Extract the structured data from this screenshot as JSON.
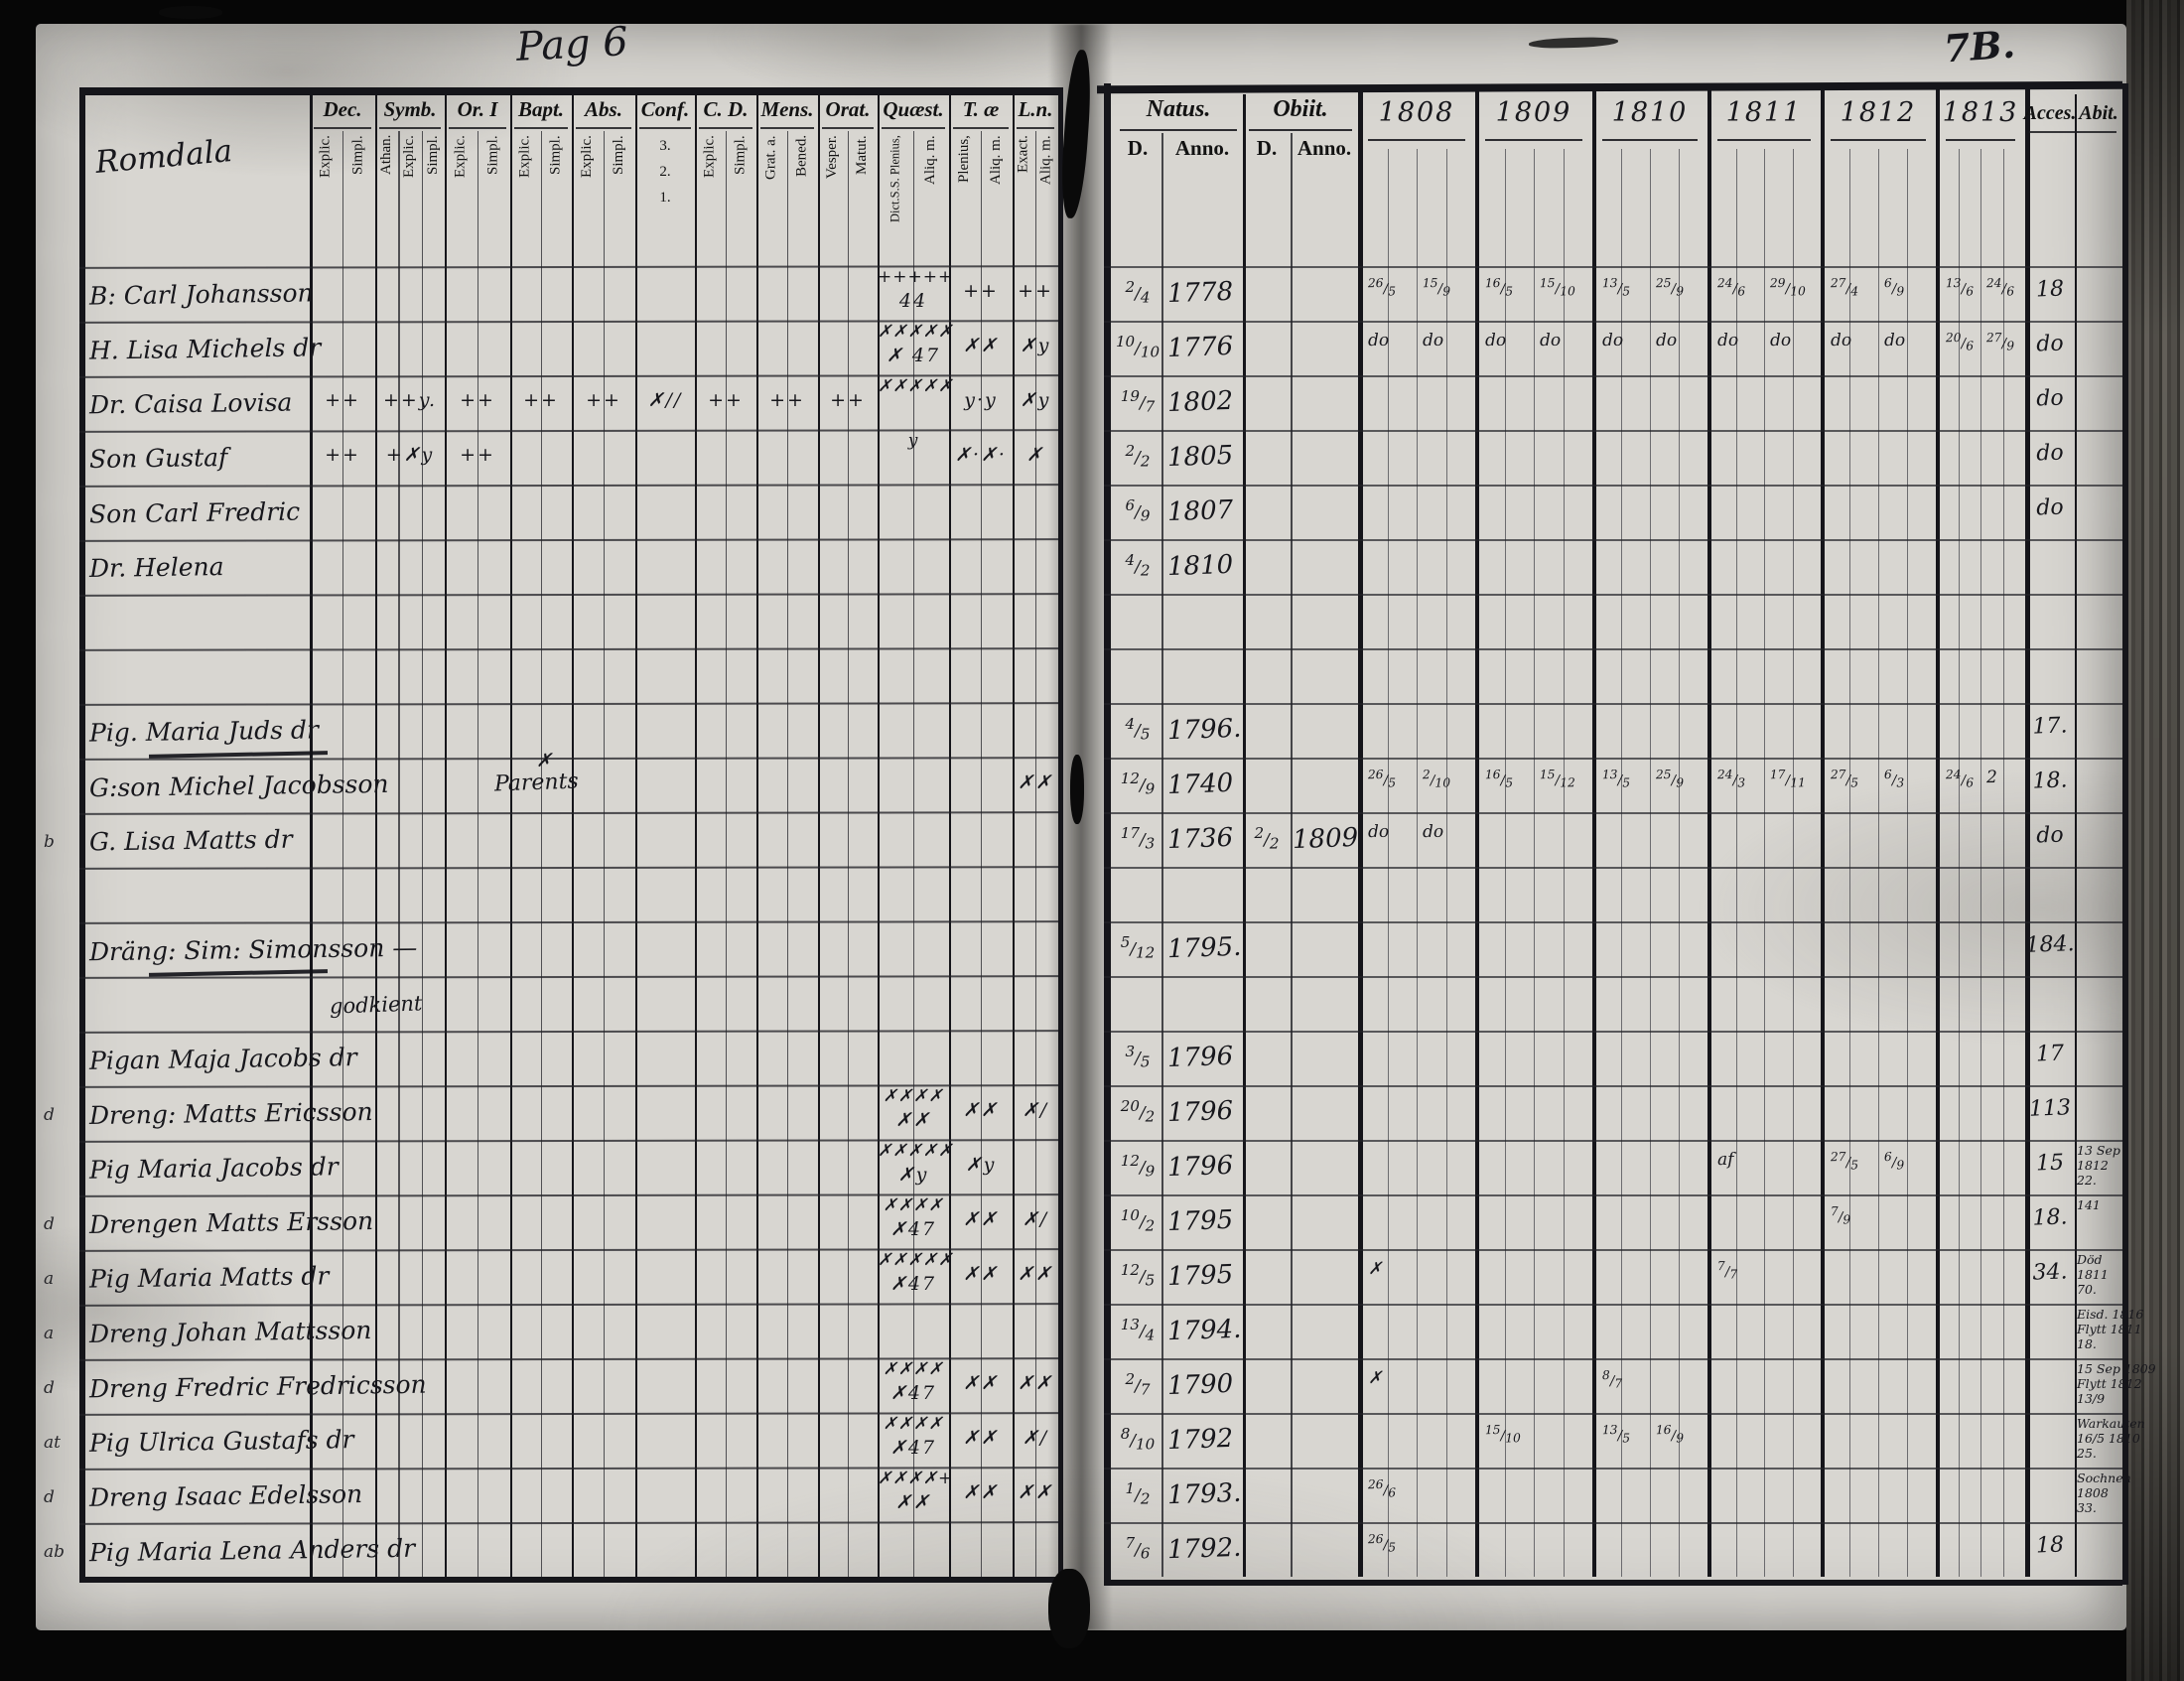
{
  "page": {
    "left_page_label": "Pag 6",
    "right_page_label": "7B.",
    "village": "Romdala"
  },
  "left_header": {
    "groups": [
      {
        "key": "dec",
        "label": "Dec.",
        "subs": [
          "Explic.",
          "Simpl."
        ]
      },
      {
        "key": "symb",
        "label": "Symb.",
        "subs": [
          "Athan.",
          "Explic.",
          "Simpl."
        ]
      },
      {
        "key": "ori",
        "label": "Or. I",
        "subs": [
          "Explic.",
          "Simpl."
        ]
      },
      {
        "key": "bapt",
        "label": "Bapt.",
        "subs": [
          "Explic.",
          "Simpl."
        ]
      },
      {
        "key": "abs",
        "label": "Abs.",
        "subs": [
          "Explic.",
          "Simpl."
        ]
      },
      {
        "key": "conf",
        "label": "Conf.",
        "subs": [
          "3.",
          "2.",
          "1."
        ],
        "stacked": true
      },
      {
        "key": "cd",
        "label": "C. D.",
        "subs": [
          "Explic.",
          "Simpl."
        ]
      },
      {
        "key": "mens",
        "label": "Mens.",
        "subs": [
          "Grat. a.",
          "Bened."
        ]
      },
      {
        "key": "orat",
        "label": "Orat.",
        "subs": [
          "Vesper.",
          "Matut."
        ]
      },
      {
        "key": "quaest",
        "label": "Quæst.",
        "subs": [
          "Dict.S.S. Plenius,",
          "Aliq. m."
        ]
      },
      {
        "key": "tae",
        "label": "T. æ",
        "subs": [
          "Plenius,",
          "Aliq. m."
        ]
      },
      {
        "key": "ln",
        "label": "L.n.",
        "subs": [
          "Exact.",
          "Aliq. m."
        ]
      }
    ]
  },
  "right_header": {
    "natus_label": "Natus.",
    "obiit_label": "Obiit.",
    "d_label": "D.",
    "anno_label": "Anno.",
    "years": [
      "1808",
      "1809",
      "1810",
      "1811",
      "1812",
      "1813"
    ],
    "acces_label": "Acces.",
    "abit_label": "Abit."
  },
  "rows": [
    {
      "name": "B: Carl Johansson",
      "natus": [
        "2/4",
        "1778"
      ],
      "marks": {
        "quaest": [
          "+++++",
          "44"
        ],
        "tae": "++",
        "ln": "++"
      },
      "years": [
        [
          "26/5",
          "15/9"
        ],
        [
          "16/5",
          "15/10"
        ],
        [
          "13/5",
          "25/9"
        ],
        [
          "24/6",
          "29/10"
        ],
        [
          "27/4",
          "6/9"
        ],
        [
          "13/6",
          "24/6"
        ]
      ],
      "acces": "18"
    },
    {
      "name": "H. Lisa Michels dr",
      "natus": [
        "10/10",
        "1776"
      ],
      "marks": {
        "quaest": [
          "✗✗✗✗✗",
          "✗ 47"
        ],
        "tae": "✗✗",
        "ln": "✗y"
      },
      "years": [
        [
          "do",
          "do"
        ],
        [
          "do",
          "do"
        ],
        [
          "do",
          "do"
        ],
        [
          "do",
          "do"
        ],
        [
          "do",
          "do"
        ],
        [
          "20/6",
          "27/9"
        ]
      ],
      "acces": "do"
    },
    {
      "name": "Dr. Caisa Lovisa",
      "natus": [
        "19/7",
        "1802"
      ],
      "marks": {
        "dec": "++",
        "symb": "++y.",
        "ori": "++",
        "bapt": "++",
        "abs": "++",
        "conf": "✗//",
        "cd": "++",
        "mens": "++",
        "orat": "++",
        "quaest": [
          "✗✗✗✗✗",
          ""
        ],
        "tae": "y·y",
        "ln": "✗y"
      },
      "acces": "do"
    },
    {
      "name": "Son Gustaf",
      "natus": [
        "2/2",
        "1805"
      ],
      "marks": {
        "dec": "++",
        "symb": "+✗y",
        "ori": "++",
        "quaest": [
          "y",
          ""
        ],
        "tae": "✗·✗·",
        "ln": "✗"
      },
      "acces": "do"
    },
    {
      "name": "Son Carl Fredric",
      "natus": [
        "6/9",
        "1807"
      ],
      "acces": "do"
    },
    {
      "name": "Dr. Helena",
      "natus": [
        "4/2",
        "1810"
      ]
    },
    {},
    {},
    {
      "name": "Pig. Maria Juds dr",
      "strike": true,
      "natus": [
        "4/5",
        "1796."
      ],
      "acces": "17."
    },
    {
      "name": "G:son Michel Jacobsson",
      "note_mark": "✗",
      "note": "Parents",
      "marks": {
        "ln": "✗✗"
      },
      "natus": [
        "12/9",
        "1740"
      ],
      "years": [
        [
          "26/5",
          "2/10"
        ],
        [
          "16/5",
          "15/12"
        ],
        [
          "13/5",
          "25/9"
        ],
        [
          "24/3",
          "17/11"
        ],
        [
          "27/5",
          "6/3"
        ],
        [
          "24/6",
          "2"
        ]
      ],
      "acces": "18."
    },
    {
      "name": "G. Lisa Matts dr",
      "margin": "b",
      "natus": [
        "17/3",
        "1736"
      ],
      "obiit": [
        "2/2",
        "1809"
      ],
      "years": [
        [
          "do",
          "do"
        ],
        [],
        [],
        [],
        [],
        []
      ],
      "acces": "do"
    },
    {},
    {
      "name": "Dräng: Sim: Simonsson —",
      "strike": true,
      "natus": [
        "5/12",
        "1795."
      ],
      "acces": "184."
    },
    {
      "note2": "godkient"
    },
    {
      "name": "Pigan Maja Jacobs dr",
      "natus": [
        "3/5",
        "1796"
      ],
      "acces": "17"
    },
    {
      "name": "Dreng: Matts Ericsson",
      "margin": "d",
      "marks": {
        "quaest": [
          "✗✗✗✗",
          "✗✗"
        ],
        "tae": "✗✗",
        "ln": "✗/"
      },
      "natus": [
        "20/2",
        "1796"
      ],
      "acces": "113"
    },
    {
      "name": "Pig Maria Jacobs dr",
      "marks": {
        "quaest": [
          "✗✗✗✗✗",
          "✗y"
        ],
        "tae": "✗y"
      },
      "natus": [
        "12/9",
        "1796"
      ],
      "years": [
        [],
        [],
        [],
        [
          "af"
        ],
        [
          "27/5",
          "6/9"
        ],
        []
      ],
      "acces": "15",
      "abit": [
        "13 Sep",
        "1812",
        "22."
      ]
    },
    {
      "name": "Drengen Matts Ersson",
      "margin": "d",
      "marks": {
        "quaest": [
          "✗✗✗✗",
          "✗47"
        ],
        "tae": "✗✗",
        "ln": "✗/"
      },
      "natus": [
        "10/2",
        "1795"
      ],
      "years": [
        [],
        [],
        [],
        [],
        [
          "7/9"
        ],
        []
      ],
      "acces": "18.",
      "abit": [
        "141"
      ]
    },
    {
      "name": "Pig Maria Matts dr",
      "margin": "a",
      "marks": {
        "quaest": [
          "✗✗✗✗✗",
          "✗47"
        ],
        "tae": "✗✗",
        "ln": "✗✗"
      },
      "natus": [
        "12/5",
        "1795"
      ],
      "years": [
        [
          "✗"
        ],
        [],
        [],
        [
          "7/7"
        ],
        [],
        []
      ],
      "acces": "34.",
      "abit": [
        "Död",
        "1811",
        "70."
      ]
    },
    {
      "name": "Dreng Johan Mattsson",
      "margin": "a",
      "natus": [
        "13/4",
        "1794."
      ],
      "abit": [
        "Eisd. 1816",
        "Flytt 1811",
        "18."
      ]
    },
    {
      "name": "Dreng Fredric Fredricsson",
      "margin": "d",
      "marks": {
        "quaest": [
          "✗✗✗✗",
          "✗47"
        ],
        "tae": "✗✗",
        "ln": "✗✗"
      },
      "natus": [
        "2/7",
        "1790"
      ],
      "years": [
        [
          "✗"
        ],
        [],
        [
          "8/7"
        ],
        [],
        [],
        []
      ],
      "abit": [
        "15 Sep 1809",
        "Flytt 1812",
        "13/9"
      ]
    },
    {
      "name": "Pig Ulrica Gustafs dr",
      "margin": "at",
      "marks": {
        "quaest": [
          "✗✗✗✗",
          "✗47"
        ],
        "tae": "✗✗",
        "ln": "✗/"
      },
      "natus": [
        "8/10",
        "1792"
      ],
      "years": [
        [],
        [
          "15/10"
        ],
        [
          "13/5",
          "16/9"
        ],
        [],
        [],
        []
      ],
      "abit": [
        "Warkauten",
        "16/5 1810",
        "25."
      ]
    },
    {
      "name": "Dreng Isaac Edelsson",
      "margin": "d",
      "marks": {
        "quaest": [
          "✗✗✗✗+",
          "✗✗"
        ],
        "tae": "✗✗",
        "ln": "✗✗"
      },
      "natus": [
        "1/2",
        "1793."
      ],
      "years": [
        [
          "26/6"
        ],
        [],
        [],
        [],
        [],
        []
      ],
      "abit": [
        "Sochnen",
        "1808",
        "33."
      ]
    },
    {
      "name": "Pig Maria Lena Anders dr",
      "margin": "ab",
      "natus": [
        "7/6",
        "1792."
      ],
      "years": [
        [
          "26/5"
        ],
        [],
        [],
        [],
        [],
        []
      ],
      "acces": "18"
    }
  ]
}
